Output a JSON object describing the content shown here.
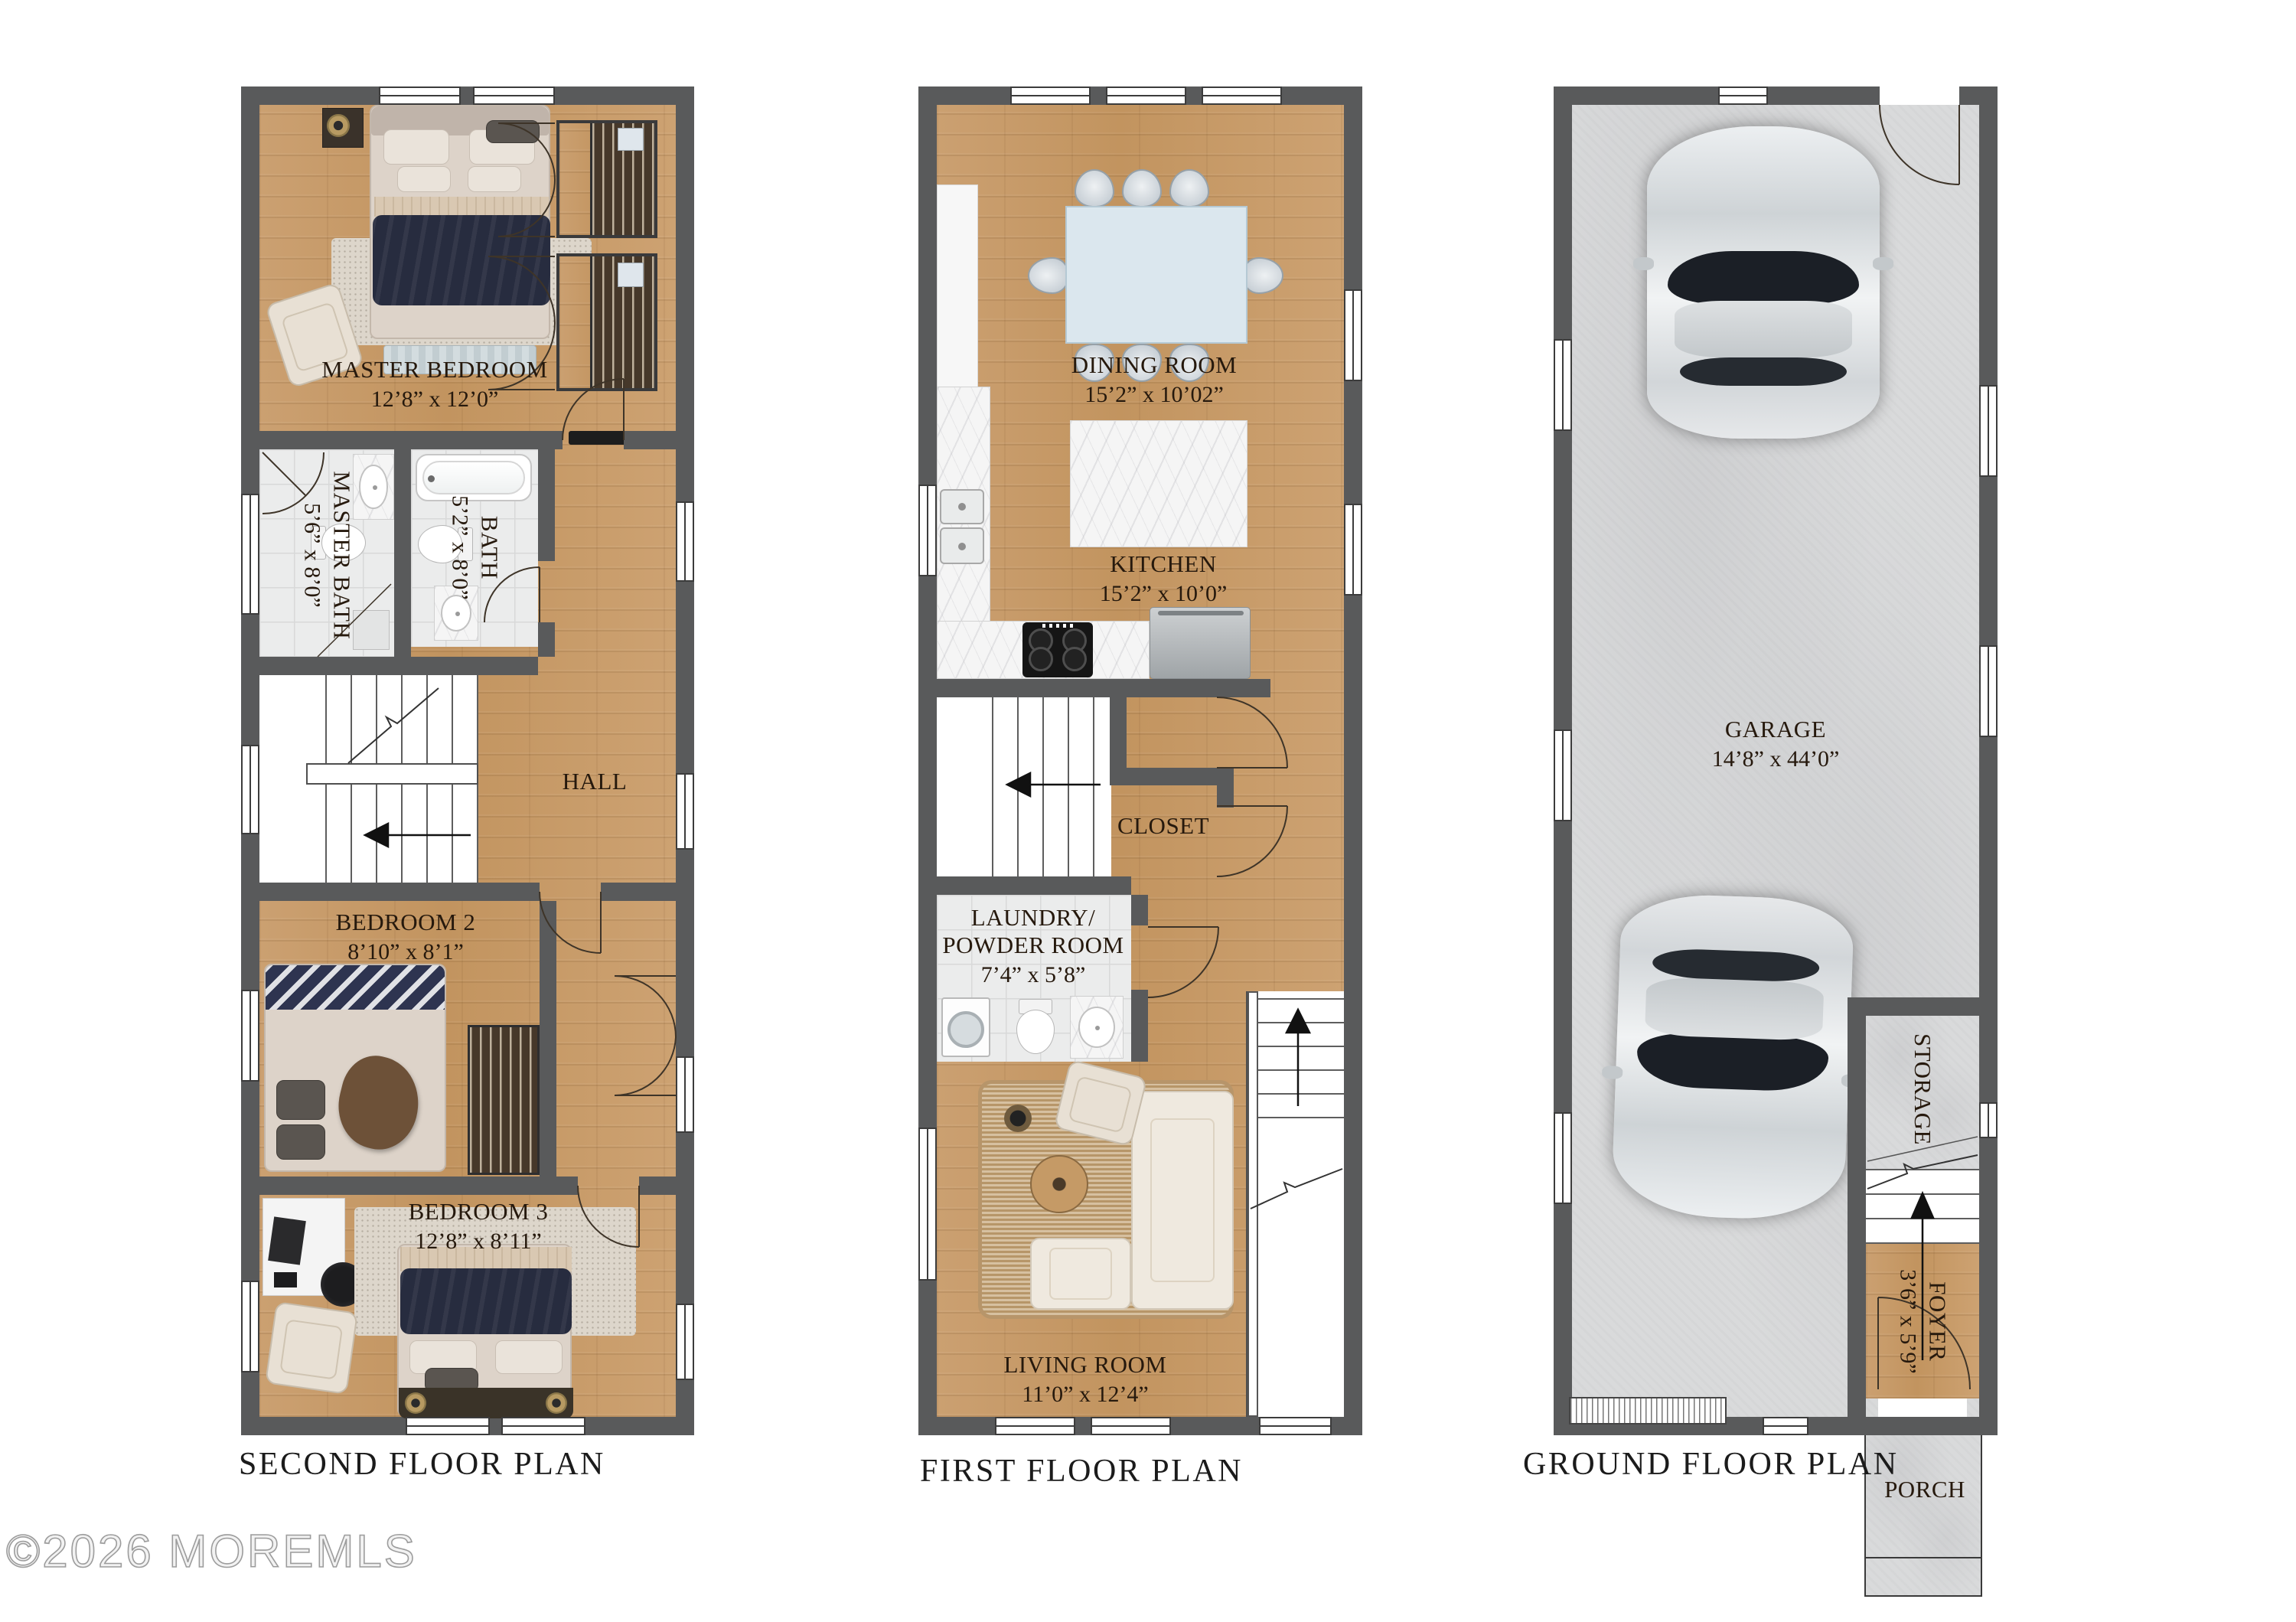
{
  "watermark": "©2026 MOREMLS",
  "colors": {
    "wall": "#595a5b",
    "wood_floor": "#c89e6e",
    "tile_floor": "#ebecec",
    "concrete_floor": "#d9dadb",
    "label_text": "#26190d",
    "title_text": "#1b1b1b"
  },
  "plans": {
    "second": {
      "title": "SECOND FLOOR PLAN",
      "rooms": {
        "master_bedroom": {
          "name": "MASTER BEDROOM",
          "dims": "12’8” x 12’0”"
        },
        "master_bath": {
          "name": "MASTER BATH",
          "dims": "5’6” x 8’0”"
        },
        "bath": {
          "name": "BATH",
          "dims": "5’2” x 8’0”"
        },
        "hall": {
          "name": "HALL"
        },
        "bedroom2": {
          "name": "BEDROOM 2",
          "dims": "8’10” x 8’1”"
        },
        "bedroom3": {
          "name": "BEDROOM 3",
          "dims": "12’8” x 8’11”"
        }
      }
    },
    "first": {
      "title": "FIRST FLOOR PLAN",
      "rooms": {
        "dining": {
          "name": "DINING ROOM",
          "dims": "15’2” x 10’02”"
        },
        "kitchen": {
          "name": "KITCHEN",
          "dims": "15’2” x 10’0”"
        },
        "closet": {
          "name": "CLOSET"
        },
        "laundry": {
          "line1": "LAUNDRY/",
          "line2": "POWDER ROOM",
          "dims": "7’4” x 5’8”"
        },
        "living": {
          "name": "LIVING ROOM",
          "dims": "11’0” x 12’4”"
        }
      }
    },
    "ground": {
      "title": "GROUND FLOOR PLAN",
      "rooms": {
        "garage": {
          "name": "GARAGE",
          "dims": "14’8” x 44’0”"
        },
        "storage": {
          "name": "STORAGE"
        },
        "foyer": {
          "name": "FOYER",
          "dims": "3’6” x 5’9”"
        },
        "porch": {
          "name": "PORCH"
        }
      }
    }
  }
}
